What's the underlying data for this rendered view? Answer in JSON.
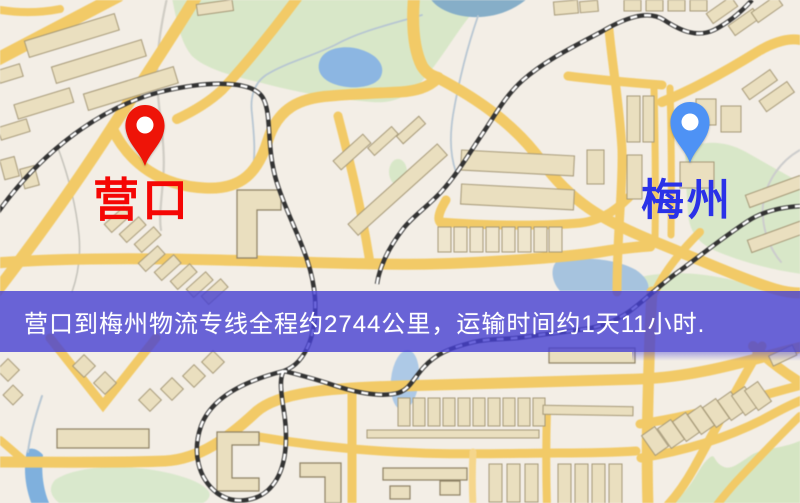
{
  "banner": {
    "text": "营口到梅州物流专线全程约2744公里，运输时间约1天11小时.",
    "background_color": "#4640d2",
    "text_color": "#ffffff"
  },
  "markers": {
    "origin": {
      "name": "营口",
      "pin_color": "#ee1408",
      "label_color": "#f50604"
    },
    "destination": {
      "name": "梅州",
      "pin_color": "#4e92f5",
      "label_color": "#2a32e8"
    }
  },
  "map_colors": {
    "background": "#f3eee6",
    "road": "#f2ca67",
    "building": "#eadfbf",
    "park": "#d8e7c8",
    "water": "#8cb6e2",
    "railway": "#333333"
  }
}
